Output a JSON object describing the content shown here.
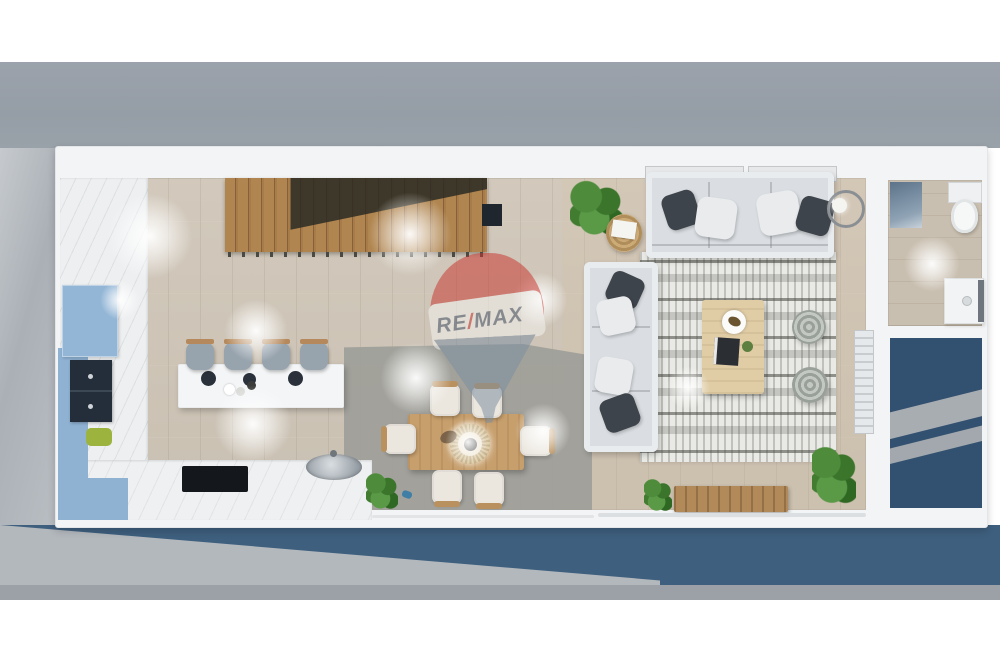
{
  "scene": {
    "type": "3d-floor-plan-render",
    "view": "top-down",
    "description": "Rendered top-down floor plan of an open-plan apartment with kitchen, dining area, living room, staircase, bathroom and terrace"
  },
  "watermark": {
    "brand": "RE/MAX",
    "part1": "RE",
    "slash": "/",
    "part2": "MAX",
    "balloon_colors": {
      "top": "#c9352e",
      "band": "#f5f4f1",
      "bottom": "#7b8ea1"
    }
  },
  "rooms": {
    "kitchen": {
      "island_stools": 4,
      "appliances": [
        "refrigerator",
        "oven-column",
        "cooktop",
        "sink"
      ],
      "cabinet_color": "#8fb2d3",
      "counter_color": "#eef0f1"
    },
    "dining": {
      "chairs": 6,
      "table_material": "wood",
      "centerpiece": "round-rattan-tray"
    },
    "living": {
      "sofas": 2,
      "poufs": 2,
      "rug_style": "boho-black-white",
      "coffee_table_material": "wood",
      "floor_lamps": 1,
      "tv_bench_material": "wood",
      "plants": 3
    },
    "bathroom": {
      "fixtures": [
        "shower",
        "toilet",
        "vanity"
      ]
    },
    "stairs": {
      "treads": 20,
      "material": "wood"
    }
  },
  "colors": {
    "exterior_top_band": "#9aa1a9",
    "exterior_left": "#b7bcc1",
    "terrace_blue": "#3e5f7e",
    "right_patio_navy": "#32506f",
    "walls_white": "#f3f4f5",
    "wood_floor": "#cec5b8",
    "dining_floor_patch": "#a5a5a1",
    "stairs_wood": "#a97f4f"
  }
}
